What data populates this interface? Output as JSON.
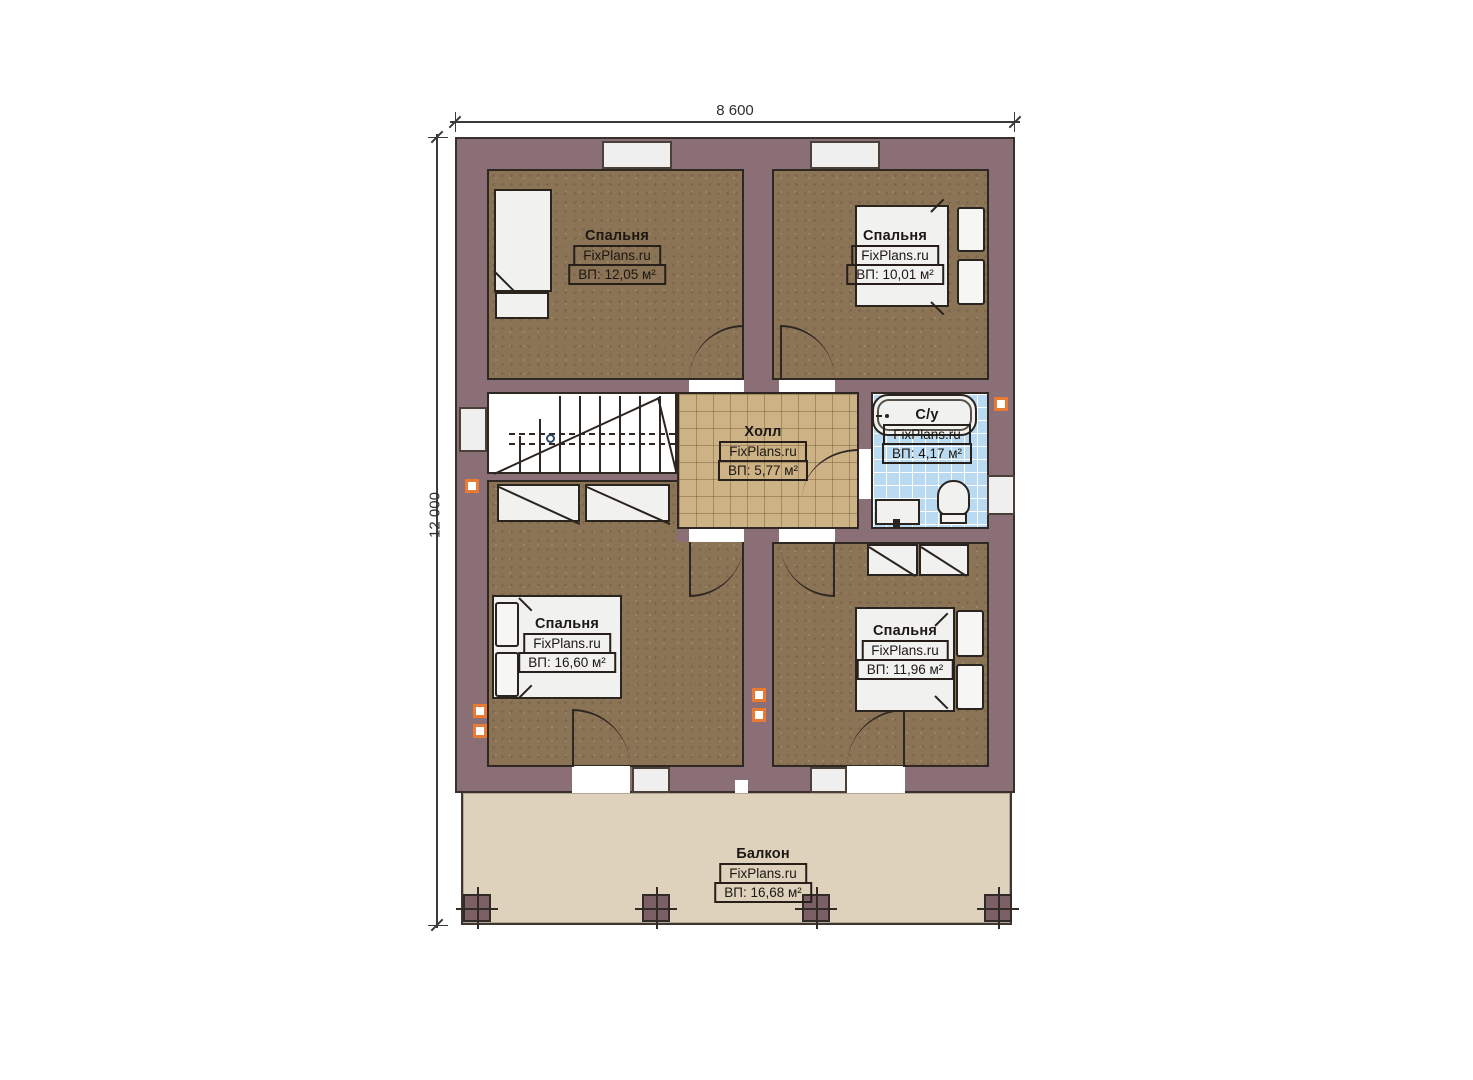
{
  "dimensions": {
    "width_label": "8 600",
    "height_label": "12 000"
  },
  "rooms": {
    "bedroom_top_left": {
      "name": "Спальня",
      "brand": "FixPlans.ru",
      "area": "ВП: 12,05 м²"
    },
    "bedroom_top_right": {
      "name": "Спальня",
      "brand": "FixPlans.ru",
      "area": "ВП: 10,01 м²"
    },
    "hall": {
      "name": "Холл",
      "brand": "FixPlans.ru",
      "area": "ВП: 5,77 м²"
    },
    "bathroom": {
      "name": "С/у",
      "brand": "FixPlans.ru",
      "area": "ВП: 4,17 м²"
    },
    "bedroom_bottom_left": {
      "name": "Спальня",
      "brand": "FixPlans.ru",
      "area": "ВП: 16,60 м²"
    },
    "bedroom_bottom_right": {
      "name": "Спальня",
      "brand": "FixPlans.ru",
      "area": "ВП: 11,96 м²"
    },
    "balcony": {
      "name": "Балкон",
      "brand": "FixPlans.ru",
      "area": "ВП: 16,68 м²"
    }
  },
  "colors": {
    "wall": "#8b6f77",
    "bedroom_floor": "#8b7356",
    "hall_tile": "#cdb286",
    "bathroom_tile": "#badaf2",
    "balcony_floor": "#ded2bd",
    "marker_orange": "#e87a33"
  }
}
